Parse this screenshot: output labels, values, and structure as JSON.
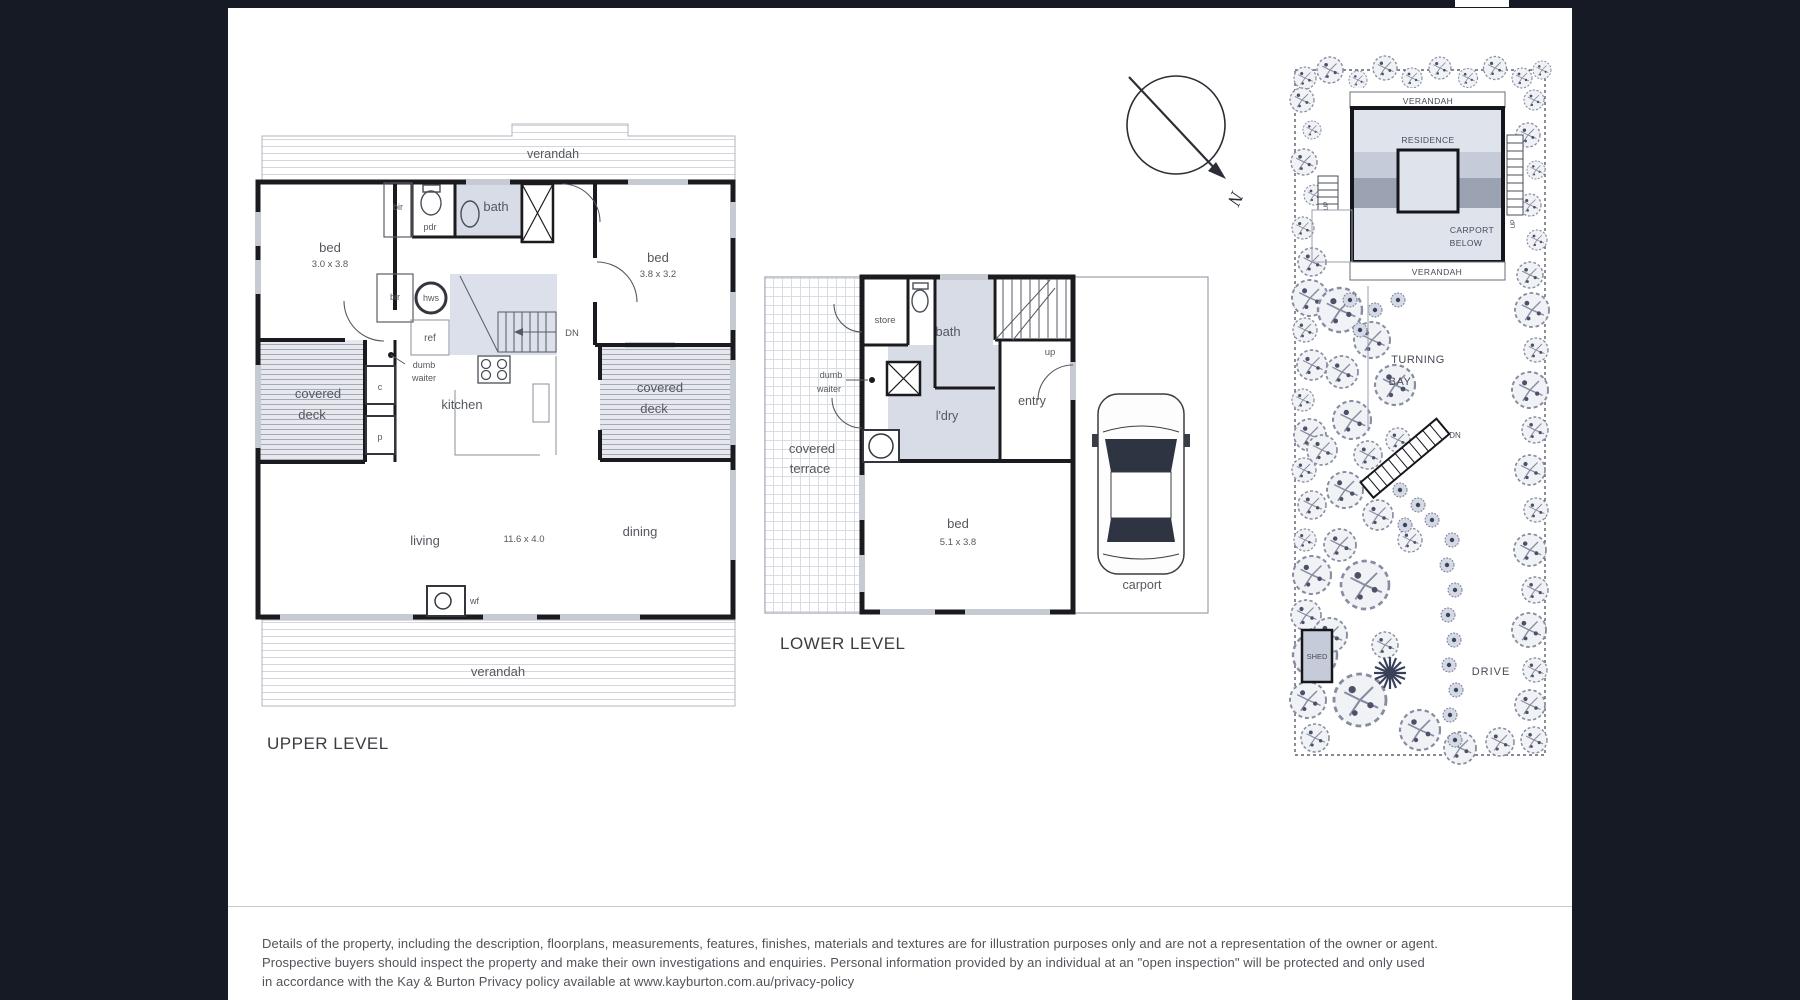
{
  "upper": {
    "title": "UPPER LEVEL",
    "verandah_top": "verandah",
    "verandah_bottom": "verandah",
    "bed1": "bed",
    "bed1_dims": "3.0 x 3.8",
    "bed2": "bed",
    "bed2_dims": "3.8 x 3.2",
    "bir1": "bir",
    "bir2": "bir",
    "pdr": "pdr",
    "bath": "bath",
    "hws": "hws",
    "ref": "ref",
    "dn": "DN",
    "dumb1": "dumb",
    "dumb2": "waiter",
    "kitchen": "kitchen",
    "deck_left1": "covered",
    "deck_left2": "deck",
    "deck_right1": "covered",
    "deck_right2": "deck",
    "c": "c",
    "p": "p",
    "living": "living",
    "living_dims": "11.6 x 4.0",
    "dining": "dining",
    "wf": "wf"
  },
  "lower": {
    "title": "LOWER LEVEL",
    "store": "store",
    "bath": "bath",
    "up": "up",
    "dumb1": "dumb",
    "dumb2": "waiter",
    "ldry": "l'dry",
    "entry": "entry",
    "terrace1": "covered",
    "terrace2": "terrace",
    "bed": "bed",
    "bed_dims": "5.1 x 3.8",
    "carport": "carport"
  },
  "site": {
    "verandah_top": "VERANDAH",
    "residence": "RESIDENCE",
    "carport_below1": "CARPORT",
    "carport_below2": "BELOW",
    "verandah_bottom": "VERANDAH",
    "up_left": "UP",
    "up_right": "UP",
    "turning1": "TURNING",
    "turning2": "BAY",
    "dn": "DN",
    "shed": "SHED",
    "drive": "DRIVE"
  },
  "compass": {
    "north": "N"
  },
  "colors": {
    "background": "#161a25",
    "sheet": "#ffffff",
    "wall": "#1b1b1f",
    "room_fill": "#d8dce6",
    "label": "#55585f"
  },
  "disclaimer": {
    "line1": "Details of the property, including the description, floorplans, measurements, features, finishes, materials and textures are for illustration purposes only and are not a representation of the owner or agent.",
    "line2": "Prospective buyers should inspect the property and make their own investigations and enquiries.  Personal information provided by an individual at an \"open inspection\" will be protected and only used",
    "line3": "in accordance with the Kay & Burton Privacy policy  available at  www.kayburton.com.au/privacy-policy"
  }
}
